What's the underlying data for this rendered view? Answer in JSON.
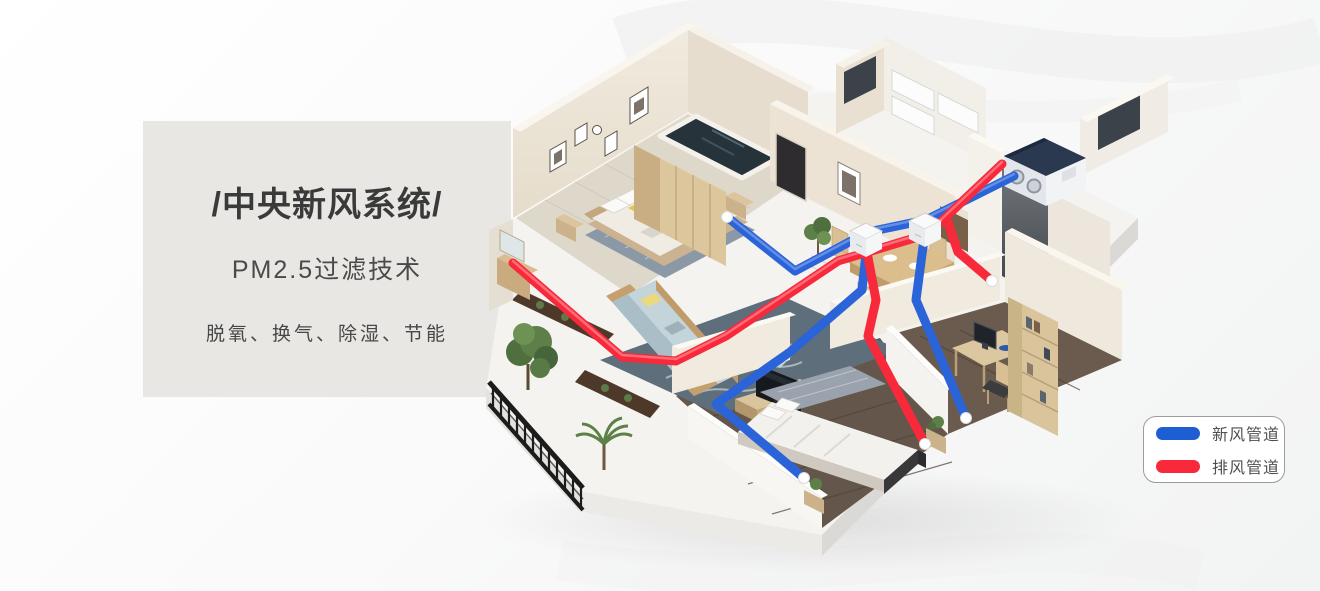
{
  "panel": {
    "title": "/中央新风系统/",
    "subtitle": "PM2.5过滤技术",
    "features": "脱氧、换气、除湿、节能"
  },
  "legend": {
    "items": [
      {
        "label": "新风管道",
        "color": "#1e5ed3"
      },
      {
        "label": "排风管道",
        "color": "#f7293b"
      }
    ]
  },
  "illustration": {
    "description": "3D isometric cutaway apartment showing a central fresh-air ventilation unit with blue fresh-air ducts and red exhaust ducts",
    "fresh_air_pipe_color": "#2b63d8",
    "exhaust_pipe_color": "#f7293b",
    "unit_top_color": "#2a3850"
  }
}
